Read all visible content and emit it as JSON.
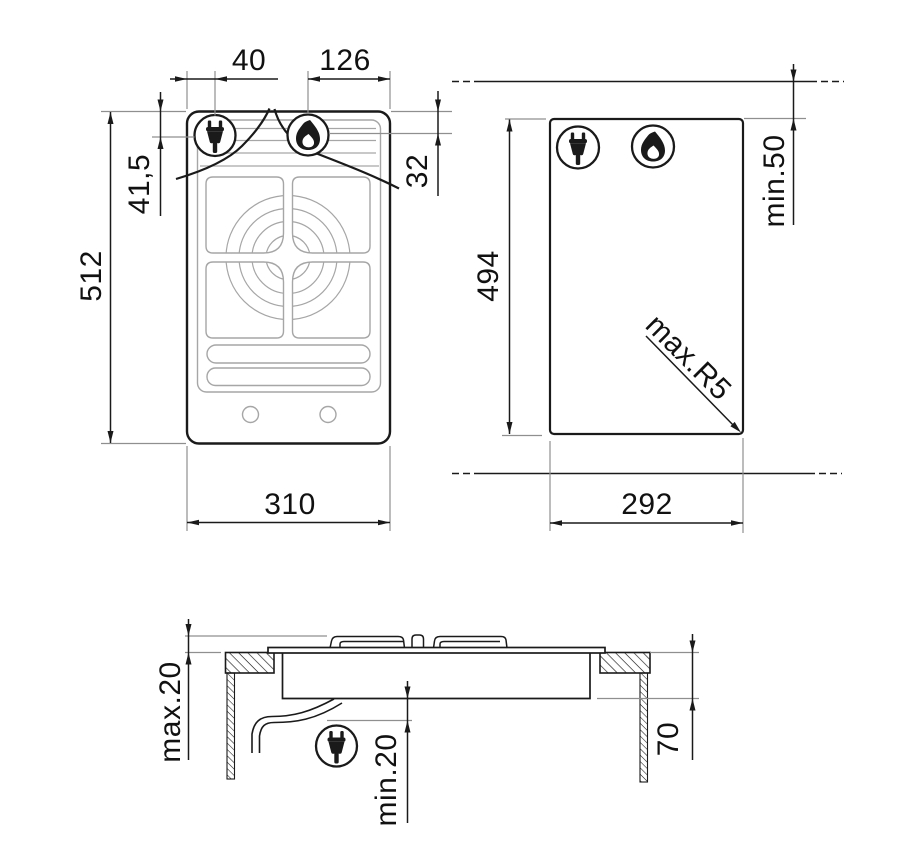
{
  "figure": {
    "kind": "appliance installation drawing",
    "views": [
      "hob top view",
      "worktop cutout plan",
      "cross section"
    ]
  },
  "colors": {
    "line": "#1a1a1a",
    "detail_gray": "#a6a6a6",
    "extension_gray": "#8f8f8f",
    "background": "#ffffff"
  },
  "icons": {
    "electric_supply": "plug-icon",
    "gas_burner": "flame-icon"
  },
  "top_view": {
    "dim_plug_from_left": "40",
    "dim_flame_zone": "126",
    "dim_plug_from_top": "41,5",
    "dim_flame_from_top": "32",
    "dim_height": "512",
    "dim_width": "310"
  },
  "cutout_view": {
    "dim_height": "494",
    "dim_width": "292",
    "dim_wall_clearance": "min.50",
    "dim_corner_radius": "max.R5"
  },
  "section_view": {
    "dim_above_worktop": "max.20",
    "dim_cable_clearance": "min.20",
    "dim_recess_depth": "70"
  }
}
